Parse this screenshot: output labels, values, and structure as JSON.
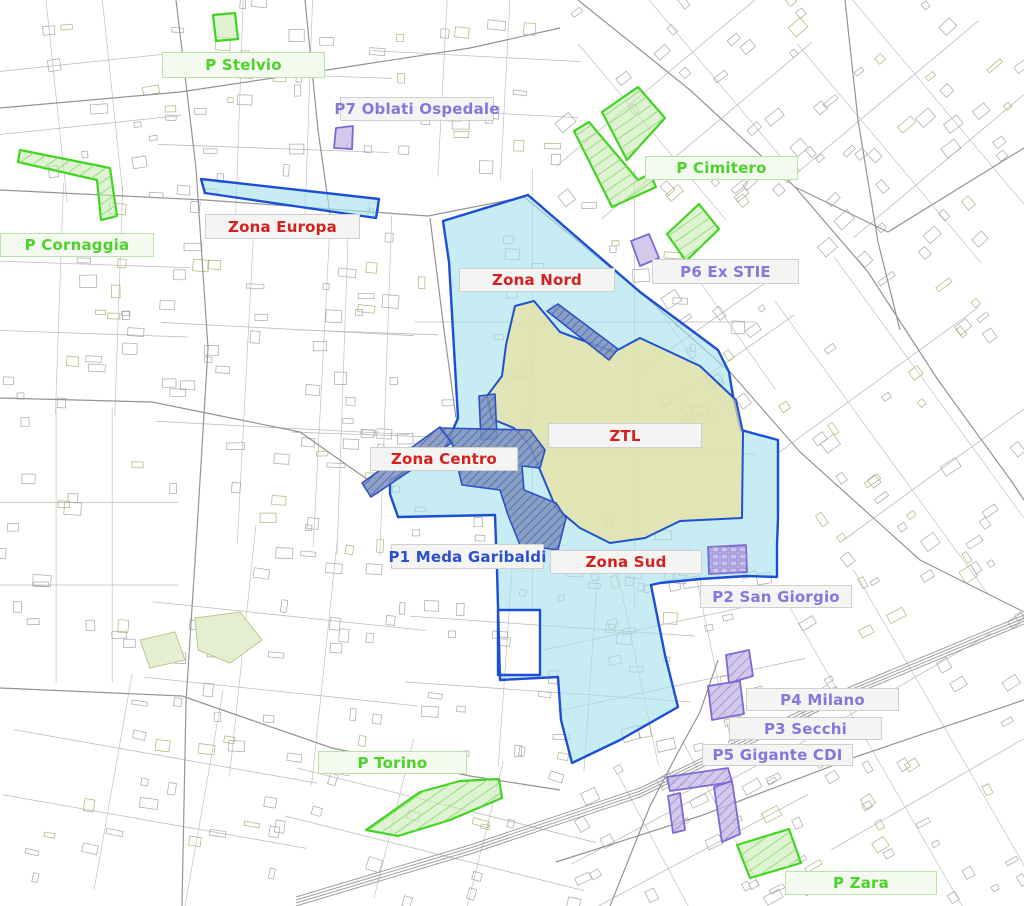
{
  "map": {
    "kind": "static traffic-zone and parking map",
    "canvas": {
      "width": 1024,
      "height": 906
    }
  },
  "colors": {
    "background": "#ffffff",
    "street_line": "#a8a8a8",
    "street_line_olive": "#b2b277",
    "road_line": "#949494",
    "rail_line": "#9e9e9e",
    "park_fill": "#e6eed2",
    "park_stroke": "#b9c98e",
    "zona_fill": "#a5e0eb",
    "zona_stroke": "#1c4ed6",
    "ztl_fill": "#eee29a",
    "ztl_stroke": "#2050d0",
    "pedonale_fill": "#7c92c0",
    "pedonale_stroke": "#2b50c8",
    "pedonale_hatch": "#4a5f96",
    "verde_fill": "#c9e9b4",
    "verde_stroke": "#3fd51f",
    "verde_hatch": "#86d96a",
    "viola_fill": "#c7bce6",
    "viola_stroke": "#7f68d6",
    "viola_hatch": "#8d7ad0",
    "label_red": "#d42020",
    "label_green": "#4cd32a",
    "label_purple": "#8976dd",
    "label_blue": "#2b50cc",
    "label_bg": "#f4f4f3",
    "label_border": "#cfcfd2",
    "label_border_green": "#b9e4a7"
  },
  "areas": [
    {
      "id": "zona-europa",
      "name": "Zona Europa strip",
      "category": "zona",
      "hatched": false,
      "polygon": [
        [
          201,
          179
        ],
        [
          379,
          199
        ],
        [
          376,
          218
        ],
        [
          205,
          193
        ]
      ]
    },
    {
      "id": "zona-nord-centro-sud",
      "name": "Zona Nord / Centro / Sud",
      "category": "zona",
      "hatched": false,
      "polygon": [
        [
          528,
          195
        ],
        [
          640,
          292
        ],
        [
          718,
          350
        ],
        [
          729,
          372
        ],
        [
          733,
          396
        ],
        [
          741,
          430
        ],
        [
          778,
          440
        ],
        [
          778,
          518
        ],
        [
          777,
          545
        ],
        [
          777,
          577
        ],
        [
          747,
          576
        ],
        [
          700,
          579
        ],
        [
          660,
          583
        ],
        [
          651,
          585
        ],
        [
          665,
          655
        ],
        [
          678,
          707
        ],
        [
          620,
          740
        ],
        [
          572,
          763
        ],
        [
          561,
          720
        ],
        [
          558,
          677
        ],
        [
          500,
          680
        ],
        [
          497,
          570
        ],
        [
          495,
          515
        ],
        [
          398,
          517
        ],
        [
          390,
          494
        ],
        [
          390,
          480
        ],
        [
          430,
          460
        ],
        [
          446,
          446
        ],
        [
          458,
          418
        ],
        [
          449,
          262
        ],
        [
          443,
          221
        ]
      ],
      "hole": [
        [
          498,
          610
        ],
        [
          540,
          610
        ],
        [
          540,
          675
        ],
        [
          498,
          675
        ]
      ]
    },
    {
      "id": "ztl",
      "name": "ZTL",
      "category": "ztl",
      "hatched": false,
      "polygon": [
        [
          515,
          306
        ],
        [
          534,
          301
        ],
        [
          560,
          332
        ],
        [
          614,
          352
        ],
        [
          640,
          338
        ],
        [
          700,
          366
        ],
        [
          736,
          400
        ],
        [
          743,
          432
        ],
        [
          742,
          518
        ],
        [
          680,
          521
        ],
        [
          645,
          538
        ],
        [
          610,
          543
        ],
        [
          580,
          528
        ],
        [
          556,
          508
        ],
        [
          540,
          470
        ],
        [
          530,
          446
        ],
        [
          514,
          428
        ],
        [
          492,
          419
        ],
        [
          487,
          396
        ],
        [
          502,
          376
        ],
        [
          506,
          345
        ]
      ]
    },
    {
      "id": "area-pedonale-band",
      "name": "pedestrian band",
      "category": "pedonale",
      "hatched": true,
      "polygon": [
        [
          547,
          311
        ],
        [
          558,
          304
        ],
        [
          618,
          349
        ],
        [
          609,
          360
        ]
      ]
    },
    {
      "id": "area-pedonale-arm-top",
      "name": "pedestrian north arm",
      "category": "pedonale",
      "hatched": true,
      "polygon": [
        [
          479,
          396
        ],
        [
          495,
          394
        ],
        [
          497,
          438
        ],
        [
          481,
          440
        ]
      ]
    },
    {
      "id": "area-pedonale-arm-left",
      "name": "pedestrian west arm",
      "category": "pedonale",
      "hatched": true,
      "polygon": [
        [
          362,
          483
        ],
        [
          440,
          427
        ],
        [
          453,
          442
        ],
        [
          371,
          497
        ]
      ]
    },
    {
      "id": "area-pedonale-centro",
      "name": "pedestrian core",
      "category": "pedonale",
      "hatched": true,
      "polygon": [
        [
          440,
          428
        ],
        [
          530,
          430
        ],
        [
          545,
          450
        ],
        [
          540,
          468
        ],
        [
          522,
          466
        ],
        [
          524,
          490
        ],
        [
          556,
          503
        ],
        [
          566,
          518
        ],
        [
          558,
          550
        ],
        [
          520,
          545
        ],
        [
          508,
          515
        ],
        [
          500,
          490
        ],
        [
          462,
          485
        ],
        [
          452,
          443
        ]
      ]
    },
    {
      "id": "p-stelvio-area",
      "name": "P Stelvio parking",
      "category": "verde",
      "hatched": false,
      "polygon": [
        [
          213,
          15
        ],
        [
          235,
          13
        ],
        [
          238,
          39
        ],
        [
          216,
          41
        ]
      ]
    },
    {
      "id": "p-cornaggia-area",
      "name": "P Cornaggia parking",
      "category": "verde",
      "hatched": true,
      "polygon": [
        [
          20,
          150
        ],
        [
          110,
          168
        ],
        [
          117,
          216
        ],
        [
          101,
          220
        ],
        [
          97,
          180
        ],
        [
          18,
          162
        ]
      ]
    },
    {
      "id": "p-cimitero-area-1",
      "name": "P Cimitero parking 1",
      "category": "verde",
      "hatched": true,
      "polygon": [
        [
          602,
          112
        ],
        [
          638,
          87
        ],
        [
          665,
          118
        ],
        [
          627,
          160
        ]
      ]
    },
    {
      "id": "p-cimitero-area-2",
      "name": "P Cimitero parking 2",
      "category": "verde",
      "hatched": true,
      "polygon": [
        [
          574,
          131
        ],
        [
          589,
          122
        ],
        [
          638,
          180
        ],
        [
          650,
          174
        ],
        [
          656,
          187
        ],
        [
          612,
          207
        ]
      ]
    },
    {
      "id": "p-cimitero-area-3",
      "name": "P Cimitero parking 3",
      "category": "verde",
      "hatched": true,
      "polygon": [
        [
          667,
          234
        ],
        [
          699,
          204
        ],
        [
          719,
          229
        ],
        [
          686,
          261
        ]
      ]
    },
    {
      "id": "p-torino-area",
      "name": "P Torino parking",
      "category": "verde",
      "hatched": true,
      "polygon": [
        [
          366,
          830
        ],
        [
          420,
          792
        ],
        [
          460,
          781
        ],
        [
          499,
          779
        ],
        [
          502,
          798
        ],
        [
          450,
          820
        ],
        [
          398,
          836
        ]
      ]
    },
    {
      "id": "p-zara-area",
      "name": "P Zara parking",
      "category": "verde",
      "hatched": true,
      "polygon": [
        [
          737,
          845
        ],
        [
          789,
          829
        ],
        [
          801,
          863
        ],
        [
          750,
          878
        ]
      ]
    },
    {
      "id": "p7-area",
      "name": "P7 Oblati Ospedale parking",
      "category": "viola",
      "hatched": false,
      "polygon": [
        [
          336,
          128
        ],
        [
          353,
          126
        ],
        [
          352,
          149
        ],
        [
          334,
          148
        ]
      ]
    },
    {
      "id": "p6-area",
      "name": "P6 Ex STIE parking",
      "category": "viola",
      "hatched": false,
      "polygon": [
        [
          631,
          241
        ],
        [
          649,
          234
        ],
        [
          659,
          258
        ],
        [
          640,
          266
        ]
      ]
    },
    {
      "id": "p2-area",
      "name": "P2 San Giorgio parking",
      "category": "viola",
      "hatched": true,
      "grid": true,
      "polygon": [
        [
          708,
          547
        ],
        [
          746,
          545
        ],
        [
          747,
          572
        ],
        [
          709,
          574
        ]
      ]
    },
    {
      "id": "p4-area-1",
      "name": "P4 Milano parking 1",
      "category": "viola",
      "hatched": true,
      "polygon": [
        [
          726,
          655
        ],
        [
          749,
          650
        ],
        [
          753,
          676
        ],
        [
          729,
          683
        ]
      ]
    },
    {
      "id": "p4-area-2",
      "name": "P4 Milano parking 2",
      "category": "viola",
      "hatched": true,
      "polygon": [
        [
          708,
          686
        ],
        [
          740,
          681
        ],
        [
          744,
          714
        ],
        [
          712,
          720
        ]
      ]
    },
    {
      "id": "p5-area-1",
      "name": "P5 Gigante CDI parking 1",
      "category": "viola",
      "hatched": true,
      "polygon": [
        [
          667,
          777
        ],
        [
          728,
          768
        ],
        [
          732,
          782
        ],
        [
          670,
          791
        ]
      ]
    },
    {
      "id": "p5-area-2",
      "name": "P5 Gigante CDI parking 2",
      "category": "viola",
      "hatched": true,
      "polygon": [
        [
          714,
          787
        ],
        [
          732,
          781
        ],
        [
          740,
          834
        ],
        [
          722,
          842
        ]
      ]
    },
    {
      "id": "p5-area-3",
      "name": "P5 Gigante CDI parking 3",
      "category": "viola",
      "hatched": true,
      "polygon": [
        [
          668,
          796
        ],
        [
          680,
          793
        ],
        [
          685,
          830
        ],
        [
          673,
          833
        ]
      ]
    }
  ],
  "labels": [
    {
      "id": "p-stelvio",
      "text": "P Stelvio",
      "category": "verde",
      "box": [
        162,
        52,
        163,
        26
      ]
    },
    {
      "id": "p7-oblati-ospedale",
      "text": "P7 Oblati Ospedale",
      "category": "viola",
      "box": [
        340,
        97,
        154,
        24
      ]
    },
    {
      "id": "p-cimitero",
      "text": "P Cimitero",
      "category": "verde",
      "box": [
        645,
        156,
        153,
        24
      ]
    },
    {
      "id": "p-cornaggia",
      "text": "P Cornaggia",
      "category": "verde",
      "box": [
        0,
        233,
        154,
        24
      ]
    },
    {
      "id": "zona-europa",
      "text": "Zona Europa",
      "category": "zona",
      "box": [
        205,
        214,
        155,
        25
      ]
    },
    {
      "id": "zona-nord",
      "text": "Zona Nord",
      "category": "zona",
      "box": [
        459,
        268,
        156,
        24
      ]
    },
    {
      "id": "p6-ex-stie",
      "text": "P6 Ex STIE",
      "category": "viola",
      "box": [
        652,
        259,
        147,
        25
      ]
    },
    {
      "id": "ztl",
      "text": "ZTL",
      "category": "zona",
      "box": [
        548,
        423,
        154,
        25
      ]
    },
    {
      "id": "zona-centro",
      "text": "Zona Centro",
      "category": "zona",
      "box": [
        370,
        447,
        148,
        24
      ]
    },
    {
      "id": "p1-meda-garibaldi",
      "text": "P1 Meda Garibaldi",
      "category": "blu",
      "box": [
        391,
        544,
        153,
        25
      ]
    },
    {
      "id": "zona-sud",
      "text": "Zona Sud",
      "category": "zona",
      "box": [
        550,
        550,
        152,
        24
      ]
    },
    {
      "id": "p2-san-giorgio",
      "text": "P2 San Giorgio",
      "category": "viola",
      "box": [
        700,
        585,
        152,
        23
      ]
    },
    {
      "id": "p4-milano",
      "text": "P4 Milano",
      "category": "viola",
      "box": [
        746,
        688,
        153,
        23
      ]
    },
    {
      "id": "p3-secchi",
      "text": "P3 Secchi",
      "category": "viola",
      "box": [
        729,
        717,
        153,
        23
      ]
    },
    {
      "id": "p5-gigante-cdi",
      "text": "P5 Gigante CDI",
      "category": "viola",
      "box": [
        702,
        744,
        151,
        22
      ]
    },
    {
      "id": "p-torino",
      "text": "P Torino",
      "category": "verde",
      "box": [
        318,
        751,
        149,
        23
      ]
    },
    {
      "id": "p-zara",
      "text": "P Zara",
      "category": "verde",
      "box": [
        785,
        871,
        152,
        24
      ]
    }
  ]
}
